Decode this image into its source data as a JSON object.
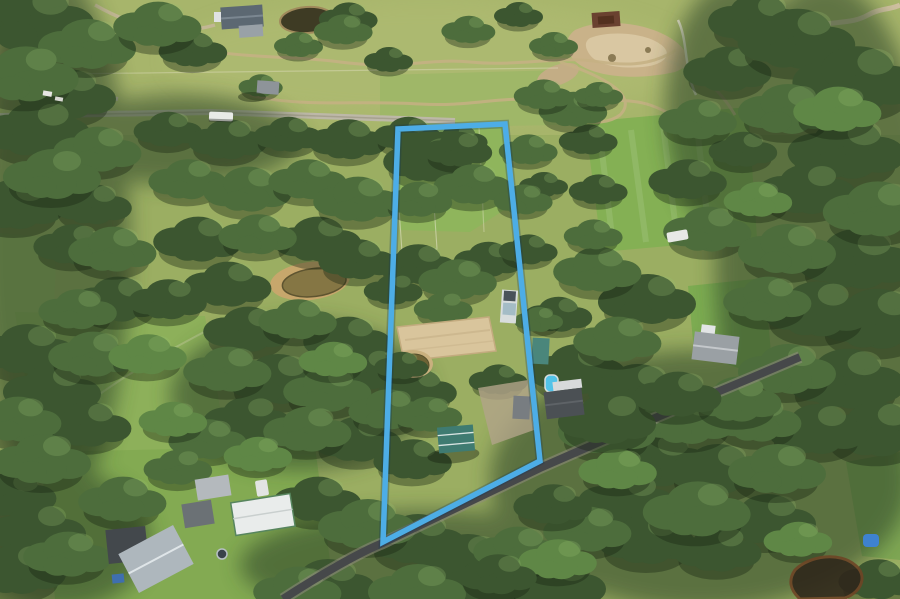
{
  "scene": {
    "type": "aerial-photograph",
    "description": "Drone aerial photograph of a semi-rural acreage property outlined with a light-blue boundary overlay, surrounded by grazing paddocks, eucalypt bushland, farm dams, sheds and neighbouring homes, with a sealed country road crossing the south-west corner",
    "width_px": 900,
    "height_px": 599
  },
  "boundary": {
    "points": "398,129 505,124 540,461 383,542",
    "color": "#4dade6",
    "glow_color": "rgba(15,50,90,0.28)",
    "stroke_width": 5.5
  },
  "palette": {
    "pasture": "#9bae62",
    "pasture_bright": "#84b054",
    "lawn": "#83aa52",
    "forest_dark": "#3c5630",
    "forest_mid": "#4d6d3c",
    "forest_light": "#5f8746",
    "arena_sand": "#d9c59c",
    "eroded_dirt": "#c9b289",
    "water_dark": "#3e3b24",
    "water_olive": "#857644",
    "road_asphalt": "#46484a",
    "road_gravel": "#bdb8a8",
    "boundary_blue": "#4dade6"
  },
  "features": [
    {
      "name": "property-boundary-outline",
      "desc": "light blue boundary overlay around the listed lot"
    },
    {
      "name": "top-paddock",
      "desc": "cleared grass paddock inside northern boundary"
    },
    {
      "name": "fenced-yard",
      "desc": "small fenced holding paddock inside boundary"
    },
    {
      "name": "sand-arena",
      "desc": "tan sand riding arena mid-property"
    },
    {
      "name": "property-dam",
      "desc": "small farm dam beside the arena"
    },
    {
      "name": "white-roof-dwelling",
      "desc": "narrow white-roofed building near eastern boundary"
    },
    {
      "name": "green-roof-shed",
      "desc": "green-roofed shed near the road frontage"
    },
    {
      "name": "gravel-yard",
      "desc": "gravel hardstand and outbuildings near boundary"
    },
    {
      "name": "road-frontage",
      "desc": "sealed country road along the south-west corner"
    },
    {
      "name": "gravel-road-north",
      "desc": "light gravel road crossing the northern paddocks"
    },
    {
      "name": "farm-tracks",
      "desc": "winding dirt tracks in the northern paddock"
    },
    {
      "name": "eroded-patch",
      "desc": "bare eroded ground to the north-east"
    },
    {
      "name": "top-pond",
      "desc": "dark farm dam in the northern paddock"
    },
    {
      "name": "left-dam",
      "desc": "olive-coloured dam west of the boundary"
    },
    {
      "name": "bottom-right-pond",
      "desc": "dark waterhole in south-east bushland"
    },
    {
      "name": "neighbour-pool",
      "desc": "blue swimming pool on adjoining eastern lot"
    },
    {
      "name": "neighbour-house-east",
      "desc": "dark-roofed house east of the boundary"
    },
    {
      "name": "large-shed-east",
      "desc": "large grey shed with lawn on eastern neighbouring lot"
    },
    {
      "name": "homestead-south-west",
      "desc": "grey-roofed homestead on neighbouring lot"
    },
    {
      "name": "white-barn-south-west",
      "desc": "white-roofed barn with green trim"
    },
    {
      "name": "white-bus",
      "desc": "white vehicle parked on the gravel road"
    },
    {
      "name": "blue-tent",
      "desc": "small blue tent in a south-east clearing"
    },
    {
      "name": "bush-reserve",
      "desc": "dense eucalypt bushland surrounding the property"
    }
  ]
}
